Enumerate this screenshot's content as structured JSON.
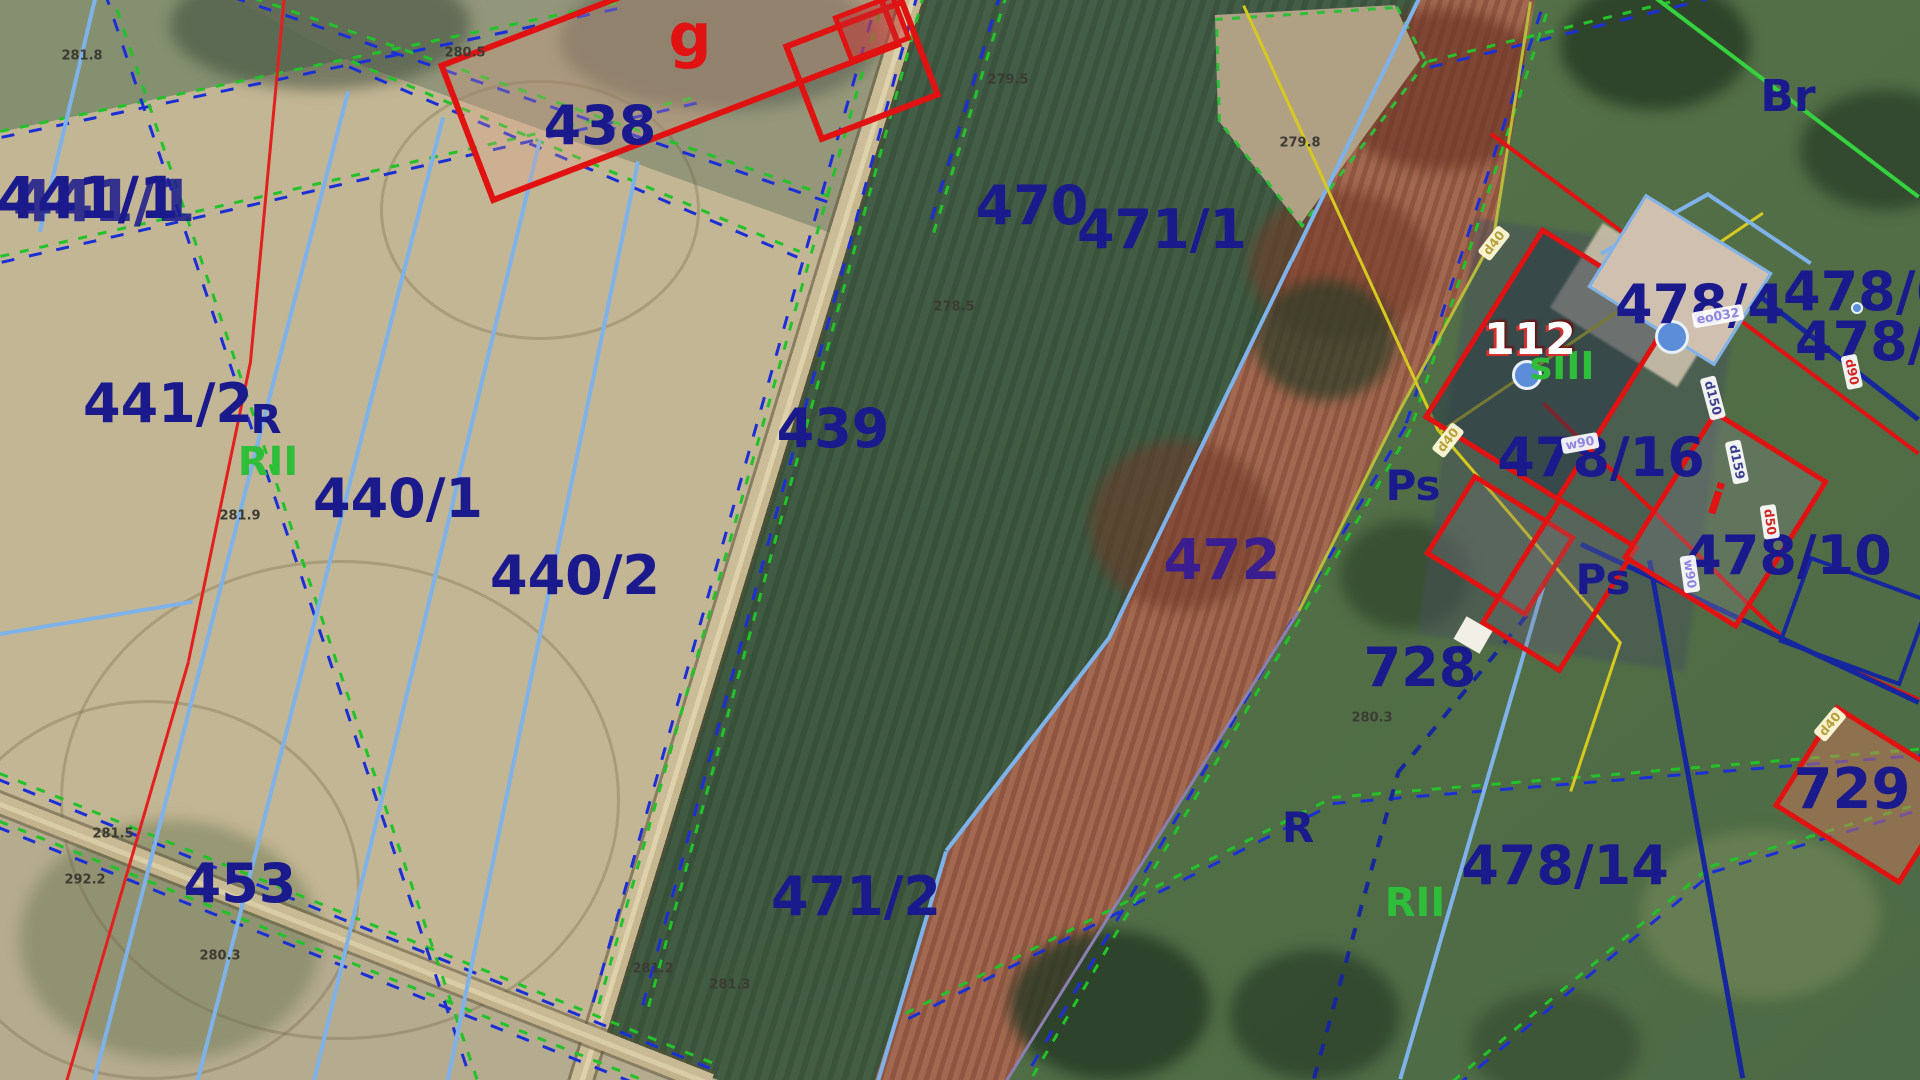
{
  "map": {
    "description": "Cadastral parcel map overlaid on aerial orthophoto",
    "colors": {
      "parcel_label": "#1a1a8c",
      "parcel_label_violet": "#3a1d8f",
      "soil_class_green": "#2fbe3a",
      "building_red": "#e01212",
      "boundary_green": "#23c22a",
      "boundary_blue": "#1b2fd4",
      "subdivision_blue": "#7fb2e8",
      "utility_yellow": "#d6c91f",
      "spot_height": "#3b3b33",
      "house_number_white": "#ffffff"
    },
    "parcel_labels": [
      {
        "text": "441/1",
        "x": 88,
        "y": 198,
        "size": 58,
        "cls": "dbl"
      },
      {
        "text": "438",
        "x": 600,
        "y": 126,
        "size": 54
      },
      {
        "text": "470",
        "x": 1032,
        "y": 206,
        "size": 54
      },
      {
        "text": "471/1",
        "x": 1162,
        "y": 230,
        "size": 54
      },
      {
        "text": "441/2",
        "x": 168,
        "y": 404,
        "size": 54
      },
      {
        "text": "440/1",
        "x": 398,
        "y": 499,
        "size": 54
      },
      {
        "text": "440/2",
        "x": 575,
        "y": 576,
        "size": 54
      },
      {
        "text": "439",
        "x": 833,
        "y": 429,
        "size": 54
      },
      {
        "text": "472",
        "x": 1222,
        "y": 561,
        "size": 56,
        "color": "#3a1d8f"
      },
      {
        "text": "453",
        "x": 240,
        "y": 884,
        "size": 54
      },
      {
        "text": "471/2",
        "x": 856,
        "y": 897,
        "size": 54
      },
      {
        "text": "728",
        "x": 1420,
        "y": 668,
        "size": 54
      },
      {
        "text": "478/14",
        "x": 1565,
        "y": 866,
        "size": 54
      },
      {
        "text": "478/16",
        "x": 1601,
        "y": 458,
        "size": 54
      },
      {
        "text": "478/4",
        "x": 1700,
        "y": 305,
        "size": 54
      },
      {
        "text": "478/6",
        "x": 1868,
        "y": 292,
        "size": 54
      },
      {
        "text": "478/3",
        "x": 1880,
        "y": 342,
        "size": 54
      },
      {
        "text": "478/10",
        "x": 1788,
        "y": 556,
        "size": 54
      },
      {
        "text": "729",
        "x": 1852,
        "y": 790,
        "size": 56
      }
    ],
    "land_use_labels": [
      {
        "text": "R",
        "x": 266,
        "y": 420,
        "size": 40,
        "color": "#1a1a8c"
      },
      {
        "text": "RII",
        "x": 268,
        "y": 462,
        "size": 40,
        "color": "#2fbe3a"
      },
      {
        "text": "Ps",
        "x": 1413,
        "y": 486,
        "size": 42,
        "color": "#1a1a8c"
      },
      {
        "text": "Ps",
        "x": 1603,
        "y": 580,
        "size": 42,
        "color": "#1a1a8c"
      },
      {
        "text": "R",
        "x": 1298,
        "y": 828,
        "size": 42,
        "color": "#1a1a8c"
      },
      {
        "text": "RII",
        "x": 1415,
        "y": 903,
        "size": 40,
        "color": "#2fbe3a"
      },
      {
        "text": "Br",
        "x": 1788,
        "y": 97,
        "size": 44,
        "color": "#1a1a8c"
      },
      {
        "text": "sIII",
        "x": 1562,
        "y": 366,
        "size": 38,
        "color": "#2fbe3a"
      }
    ],
    "building_labels": [
      {
        "text": "g",
        "x": 690,
        "y": 36,
        "size": 60,
        "color": "#e01212"
      },
      {
        "text": "112",
        "x": 1530,
        "y": 340,
        "size": 44,
        "color": "#ffffff",
        "cls": "house"
      },
      {
        "text": "i",
        "x": 1716,
        "y": 500,
        "size": 42,
        "color": "#e01212",
        "rot": 18
      }
    ],
    "spot_heights": [
      {
        "text": "281.8",
        "x": 82,
        "y": 56
      },
      {
        "text": "280.5",
        "x": 465,
        "y": 53
      },
      {
        "text": "279.5",
        "x": 1008,
        "y": 80
      },
      {
        "text": "278.5",
        "x": 954,
        "y": 307
      },
      {
        "text": "279.8",
        "x": 1300,
        "y": 143
      },
      {
        "text": "281.9",
        "x": 240,
        "y": 516
      },
      {
        "text": "281.5",
        "x": 113,
        "y": 834
      },
      {
        "text": "292.2",
        "x": 85,
        "y": 880
      },
      {
        "text": "280.3",
        "x": 220,
        "y": 956
      },
      {
        "text": "281.2",
        "x": 653,
        "y": 969
      },
      {
        "text": "281.3",
        "x": 730,
        "y": 985
      },
      {
        "text": "280.3",
        "x": 1372,
        "y": 718
      }
    ],
    "utility_badges": [
      {
        "text": "eo032",
        "x": 1718,
        "y": 316,
        "rot": -10,
        "style": "b-lav"
      },
      {
        "text": "d40",
        "x": 1494,
        "y": 243,
        "rot": -52,
        "style": "b-khaki"
      },
      {
        "text": "d40",
        "x": 1448,
        "y": 440,
        "rot": -52,
        "style": "b-khaki"
      },
      {
        "text": "d150",
        "x": 1713,
        "y": 398,
        "rot": 75,
        "style": "b-navy"
      },
      {
        "text": "d159",
        "x": 1737,
        "y": 462,
        "rot": 78,
        "style": "b-navy"
      },
      {
        "text": "d90",
        "x": 1852,
        "y": 372,
        "rot": 78,
        "style": "b-red"
      },
      {
        "text": "d50",
        "x": 1770,
        "y": 522,
        "rot": 82,
        "style": "b-red"
      },
      {
        "text": "w90",
        "x": 1690,
        "y": 574,
        "rot": 82,
        "style": "b-lav"
      },
      {
        "text": "w90",
        "x": 1580,
        "y": 443,
        "rot": -10,
        "style": "b-lav"
      },
      {
        "text": "d40",
        "x": 1830,
        "y": 724,
        "rot": -50,
        "style": "b-khaki"
      }
    ]
  }
}
